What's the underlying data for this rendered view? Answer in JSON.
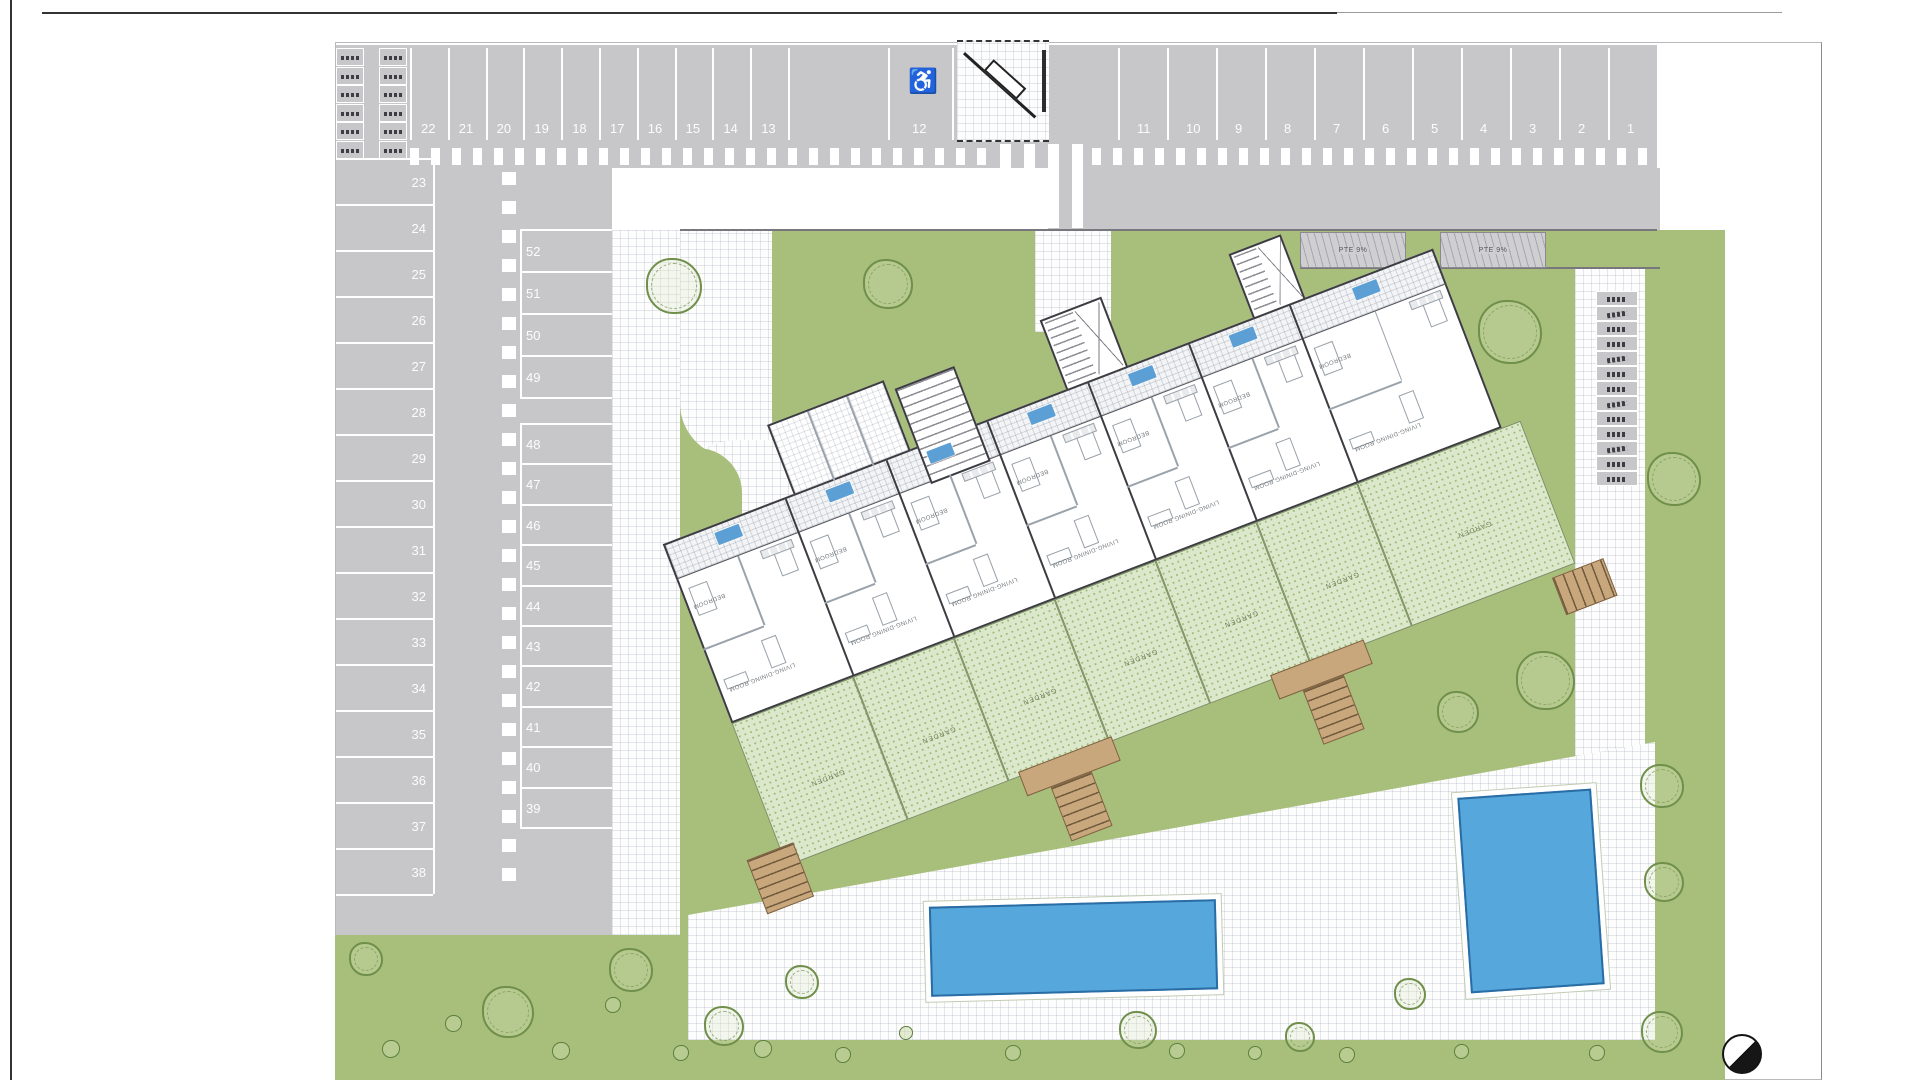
{
  "plan": {
    "title": "site-plan-ground-floor",
    "parking": {
      "top_row_left": [
        "22",
        "21",
        "20",
        "19",
        "18",
        "17",
        "16",
        "15",
        "14",
        "13"
      ],
      "handicap_space": "12",
      "handicap_icon": "♿",
      "top_row_right": [
        "11",
        "10",
        "9",
        "8",
        "7",
        "6",
        "5",
        "4",
        "3",
        "2",
        "1"
      ],
      "left_column": [
        "23",
        "24",
        "25",
        "26",
        "27",
        "28",
        "29",
        "30",
        "31",
        "32",
        "33",
        "34",
        "35",
        "36",
        "37",
        "38"
      ],
      "middle_column_upper": [
        "52",
        "51",
        "50",
        "49"
      ],
      "middle_column_lower": [
        "48",
        "47",
        "46",
        "45",
        "44",
        "43",
        "42",
        "41",
        "40",
        "39"
      ]
    },
    "ramps": {
      "left_label": "PTE 9%",
      "right_label": "PTE 9%"
    },
    "building": {
      "badge_color": "#5b9fd4",
      "units": [
        {
          "living": "LIVING-DINING ROOM",
          "bedroom": "BEDROOM",
          "garden": "GARDEN"
        },
        {
          "living": "LIVING-DINING ROOM",
          "bedroom": "BEDROOM",
          "garden": "GARDEN"
        },
        {
          "living": "LIVING-DINING ROOM",
          "bedroom": "BEDROOM",
          "garden": "GARDEN"
        },
        {
          "living": "LIVING-DINING ROOM",
          "bedroom": "BEDROOM",
          "garden": "GARDEN"
        },
        {
          "living": "LIVING-DINING ROOM",
          "bedroom": "BEDROOM",
          "garden": "GARDEN"
        },
        {
          "living": "LIVING-DINING ROOM",
          "bedroom": "BEDROOM",
          "garden": "GARDEN"
        },
        {
          "living": "LIVING-DINING ROOM",
          "bedroom": "BEDROOM",
          "garden": "GARDEN"
        }
      ]
    },
    "colors": {
      "road_gray": "#c7c7ca",
      "lawn_green": "#a8bf7c",
      "terrace_green": "#dce8cb",
      "pool_blue": "#55a7dc",
      "unit_badge_blue": "#5b9fd4",
      "deck_tan": "#c9a77c"
    }
  }
}
